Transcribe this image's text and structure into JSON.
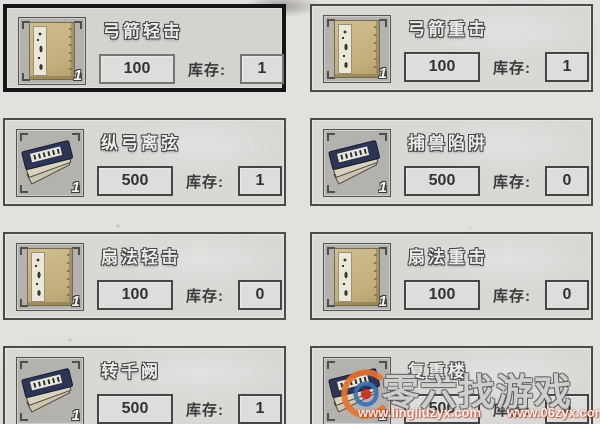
{
  "labels": {
    "stock": "库存:"
  },
  "items": [
    {
      "name": "弓箭轻击",
      "price": "100",
      "stock": "1",
      "badge": "1",
      "icon": "tan-book",
      "selected": true
    },
    {
      "name": "弓箭重击",
      "price": "100",
      "stock": "1",
      "badge": "1",
      "icon": "tan-book",
      "selected": false
    },
    {
      "name": "纵弓离弦",
      "price": "500",
      "stock": "1",
      "badge": "1",
      "icon": "blue-books",
      "selected": false
    },
    {
      "name": "捕兽陷阱",
      "price": "500",
      "stock": "0",
      "badge": "1",
      "icon": "blue-books",
      "selected": false
    },
    {
      "name": "扇法轻击",
      "price": "100",
      "stock": "0",
      "badge": "1",
      "icon": "tan-book",
      "selected": false
    },
    {
      "name": "扇法重击",
      "price": "100",
      "stock": "0",
      "badge": "1",
      "icon": "tan-book",
      "selected": false
    },
    {
      "name": "转千阙",
      "price": "500",
      "stock": "1",
      "badge": "1",
      "icon": "blue-books",
      "selected": false
    },
    {
      "name": "复重楼",
      "price": "500",
      "stock": "0",
      "badge": "1",
      "icon": "blue-books",
      "selected": false
    }
  ],
  "watermark": {
    "brand": "零六找游戏",
    "url_left": "www.lingliuzyx.com",
    "url_right": "www.06zyx.com"
  },
  "colors": {
    "page_bg": "#e3e1de",
    "card_bg": "#d9d8d5",
    "card_border": "#4a4a48",
    "selected_border": "#161616",
    "title_fill": "#ececea",
    "logo_orange": "#e8742f",
    "logo_blue": "#3a6fb5",
    "logo_red": "#c92a1e"
  }
}
